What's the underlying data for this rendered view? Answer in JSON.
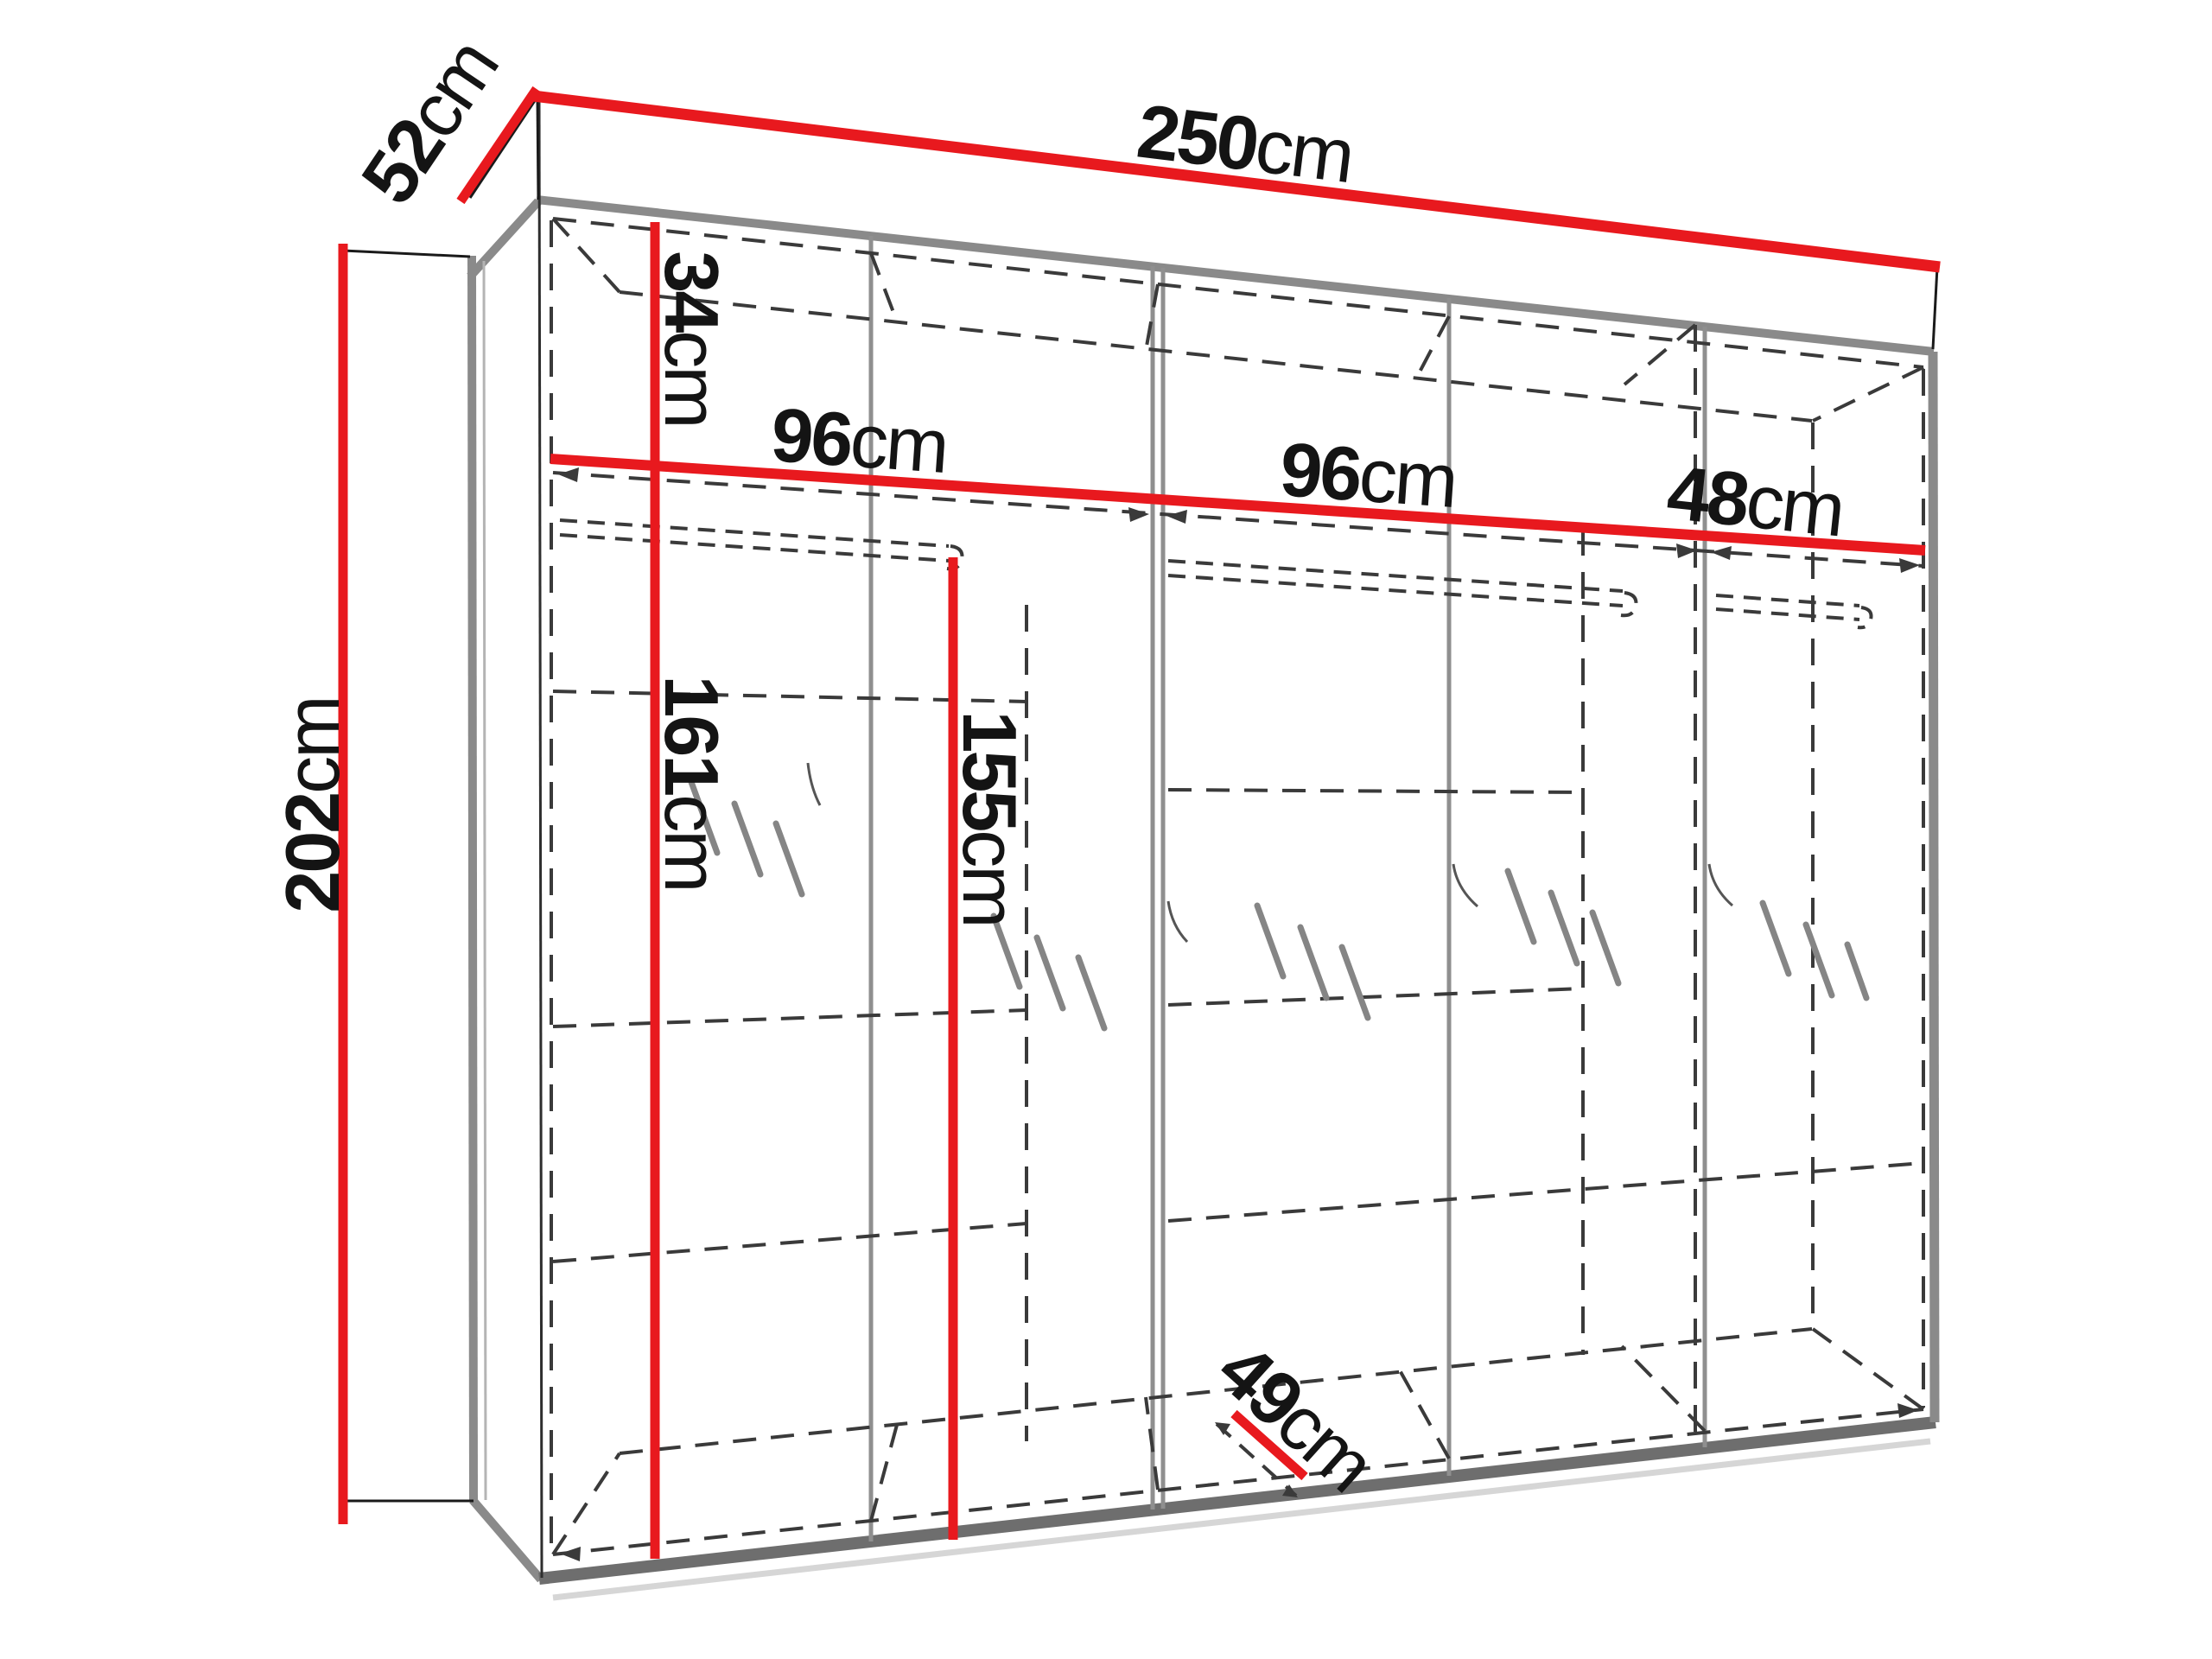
{
  "diagram": {
    "figure": "wardrobe-dimension-drawing",
    "unit": "cm",
    "colors": {
      "dimension_line": "#e8191e",
      "carcass_edge": "#8a8a8a",
      "hidden_line": "#3a3a3a",
      "label_text": "#141414",
      "background": "#ffffff"
    },
    "dimensions": {
      "width": {
        "value": "250",
        "unit": "cm"
      },
      "depth": {
        "value": "52",
        "unit": "cm"
      },
      "height": {
        "value": "202",
        "unit": "cm"
      },
      "top_compartment_height": {
        "value": "34",
        "unit": "cm"
      },
      "section_1_width": {
        "value": "96",
        "unit": "cm"
      },
      "section_2_width": {
        "value": "96",
        "unit": "cm"
      },
      "section_3_width": {
        "value": "48",
        "unit": "cm"
      },
      "interior_height_below_shelf": {
        "value": "161",
        "unit": "cm"
      },
      "hanging_space_height": {
        "value": "155",
        "unit": "cm"
      },
      "interior_depth": {
        "value": "49",
        "unit": "cm"
      }
    }
  }
}
